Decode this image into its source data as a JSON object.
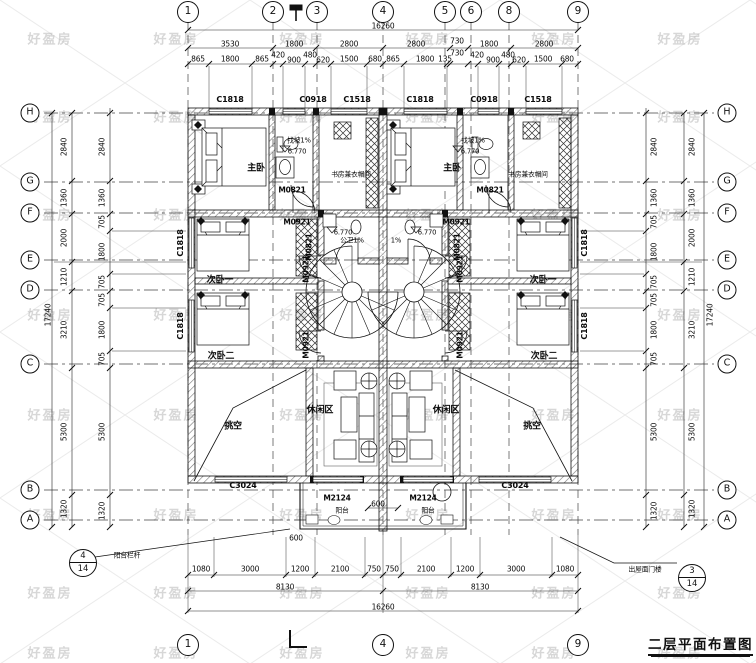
{
  "meta": {
    "title": "二层平面布置图",
    "watermark": "好盈房"
  },
  "callouts": {
    "left": {
      "num": "4",
      "den": "14",
      "text": "阳台栏杆"
    },
    "right": {
      "num": "3",
      "den": "14",
      "text": "出屋面门楼"
    }
  },
  "grid": {
    "bubbles": [
      {
        "t": "1",
        "x": 188,
        "y": 12,
        "s": "t"
      },
      {
        "t": "2",
        "x": 273,
        "y": 12,
        "s": "t"
      },
      {
        "t": "3",
        "x": 317,
        "y": 12,
        "s": "t"
      },
      {
        "t": "4",
        "x": 383,
        "y": 12,
        "s": "t"
      },
      {
        "t": "5",
        "x": 445,
        "y": 12,
        "s": "t"
      },
      {
        "t": "6",
        "x": 471,
        "y": 12,
        "s": "t"
      },
      {
        "t": "8",
        "x": 509,
        "y": 12,
        "s": "t"
      },
      {
        "t": "9",
        "x": 578,
        "y": 12,
        "s": "t"
      },
      {
        "t": "1",
        "x": 188,
        "y": 645,
        "s": "t"
      },
      {
        "t": "4",
        "x": 383,
        "y": 645,
        "s": "t"
      },
      {
        "t": "9",
        "x": 578,
        "y": 645,
        "s": "t"
      },
      {
        "t": "H",
        "x": 30,
        "y": 113,
        "s": "s"
      },
      {
        "t": "G",
        "x": 30,
        "y": 182,
        "s": "s"
      },
      {
        "t": "F",
        "x": 30,
        "y": 213,
        "s": "s"
      },
      {
        "t": "E",
        "x": 30,
        "y": 260,
        "s": "s"
      },
      {
        "t": "D",
        "x": 30,
        "y": 290,
        "s": "s"
      },
      {
        "t": "C",
        "x": 30,
        "y": 364,
        "s": "s"
      },
      {
        "t": "B",
        "x": 30,
        "y": 490,
        "s": "s"
      },
      {
        "t": "A",
        "x": 30,
        "y": 520,
        "s": "s"
      },
      {
        "t": "H",
        "x": 727,
        "y": 113,
        "s": "s"
      },
      {
        "t": "G",
        "x": 727,
        "y": 182,
        "s": "s"
      },
      {
        "t": "F",
        "x": 727,
        "y": 213,
        "s": "s"
      },
      {
        "t": "E",
        "x": 727,
        "y": 260,
        "s": "s"
      },
      {
        "t": "D",
        "x": 727,
        "y": 290,
        "s": "s"
      },
      {
        "t": "C",
        "x": 727,
        "y": 364,
        "s": "s"
      },
      {
        "t": "B",
        "x": 727,
        "y": 490,
        "s": "s"
      },
      {
        "t": "A",
        "x": 727,
        "y": 520,
        "s": "s"
      }
    ]
  },
  "labels": [
    {
      "t": "16260",
      "x": 383,
      "y": 26,
      "c": "dim"
    },
    {
      "t": "3530",
      "x": 230,
      "y": 44,
      "c": "dim"
    },
    {
      "t": "1800",
      "x": 294,
      "y": 44,
      "c": "dim"
    },
    {
      "t": "2800",
      "x": 349,
      "y": 44,
      "c": "dim"
    },
    {
      "t": "2800",
      "x": 416,
      "y": 44,
      "c": "dim"
    },
    {
      "t": "730",
      "x": 457,
      "y": 41,
      "c": "dim"
    },
    {
      "t": "1800",
      "x": 489,
      "y": 44,
      "c": "dim"
    },
    {
      "t": "2800",
      "x": 544,
      "y": 44,
      "c": "dim"
    },
    {
      "t": "865",
      "x": 198,
      "y": 59,
      "c": "dim"
    },
    {
      "t": "1800",
      "x": 230,
      "y": 59,
      "c": "dim"
    },
    {
      "t": "865",
      "x": 262,
      "y": 59,
      "c": "dim"
    },
    {
      "t": "420",
      "x": 278,
      "y": 55,
      "c": "dim"
    },
    {
      "t": "900",
      "x": 294,
      "y": 60,
      "c": "dim"
    },
    {
      "t": "480",
      "x": 310,
      "y": 55,
      "c": "dim"
    },
    {
      "t": "620",
      "x": 323,
      "y": 60,
      "c": "dim"
    },
    {
      "t": "1500",
      "x": 349,
      "y": 59,
      "c": "dim"
    },
    {
      "t": "680",
      "x": 375,
      "y": 59,
      "c": "dim"
    },
    {
      "t": "865",
      "x": 393,
      "y": 59,
      "c": "dim"
    },
    {
      "t": "1800",
      "x": 425,
      "y": 59,
      "c": "dim"
    },
    {
      "t": "135",
      "x": 445,
      "y": 59,
      "c": "dim"
    },
    {
      "t": "730",
      "x": 457,
      "y": 53,
      "c": "dim"
    },
    {
      "t": "420",
      "x": 477,
      "y": 55,
      "c": "dim"
    },
    {
      "t": "900",
      "x": 493,
      "y": 60,
      "c": "dim"
    },
    {
      "t": "480",
      "x": 508,
      "y": 55,
      "c": "dim"
    },
    {
      "t": "620",
      "x": 519,
      "y": 60,
      "c": "dim"
    },
    {
      "t": "1500",
      "x": 543,
      "y": 59,
      "c": "dim"
    },
    {
      "t": "680",
      "x": 567,
      "y": 59,
      "c": "dim"
    },
    {
      "t": "C1818",
      "x": 230,
      "y": 100,
      "c": "win"
    },
    {
      "t": "C0918",
      "x": 313,
      "y": 100,
      "c": "win"
    },
    {
      "t": "C1518",
      "x": 357,
      "y": 100,
      "c": "win"
    },
    {
      "t": "C1818",
      "x": 420,
      "y": 100,
      "c": "win"
    },
    {
      "t": "C0918",
      "x": 484,
      "y": 100,
      "c": "win"
    },
    {
      "t": "C1518",
      "x": 538,
      "y": 100,
      "c": "win"
    },
    {
      "t": "17240",
      "x": 48,
      "y": 315,
      "c": "dimv"
    },
    {
      "t": "2840",
      "x": 64,
      "y": 147,
      "c": "dimv"
    },
    {
      "t": "1360",
      "x": 64,
      "y": 198,
      "c": "dimv"
    },
    {
      "t": "2000",
      "x": 64,
      "y": 238,
      "c": "dimv"
    },
    {
      "t": "1210",
      "x": 64,
      "y": 277,
      "c": "dimv"
    },
    {
      "t": "3210",
      "x": 64,
      "y": 330,
      "c": "dimv"
    },
    {
      "t": "5300",
      "x": 64,
      "y": 432,
      "c": "dimv"
    },
    {
      "t": "1320",
      "x": 64,
      "y": 509,
      "c": "dimv"
    },
    {
      "t": "2840",
      "x": 102,
      "y": 147,
      "c": "dimv"
    },
    {
      "t": "1360",
      "x": 102,
      "y": 198,
      "c": "dimv"
    },
    {
      "t": "705",
      "x": 102,
      "y": 222,
      "c": "dimv"
    },
    {
      "t": "1800",
      "x": 102,
      "y": 252,
      "c": "dimv"
    },
    {
      "t": "705",
      "x": 102,
      "y": 282,
      "c": "dimv"
    },
    {
      "t": "705",
      "x": 102,
      "y": 300,
      "c": "dimv"
    },
    {
      "t": "1800",
      "x": 102,
      "y": 330,
      "c": "dimv"
    },
    {
      "t": "705",
      "x": 102,
      "y": 359,
      "c": "dimv"
    },
    {
      "t": "5300",
      "x": 102,
      "y": 432,
      "c": "dimv"
    },
    {
      "t": "1320",
      "x": 102,
      "y": 511,
      "c": "dimv"
    },
    {
      "t": "C1818",
      "x": 181,
      "y": 243,
      "c": "winv"
    },
    {
      "t": "C1818",
      "x": 181,
      "y": 326,
      "c": "winv"
    },
    {
      "t": "C1818",
      "x": 585,
      "y": 243,
      "c": "winv"
    },
    {
      "t": "C1818",
      "x": 585,
      "y": 326,
      "c": "winv"
    },
    {
      "t": "2840",
      "x": 654,
      "y": 147,
      "c": "dimv"
    },
    {
      "t": "1360",
      "x": 654,
      "y": 198,
      "c": "dimv"
    },
    {
      "t": "705",
      "x": 654,
      "y": 222,
      "c": "dimv"
    },
    {
      "t": "1800",
      "x": 654,
      "y": 252,
      "c": "dimv"
    },
    {
      "t": "705",
      "x": 654,
      "y": 282,
      "c": "dimv"
    },
    {
      "t": "705",
      "x": 654,
      "y": 300,
      "c": "dimv"
    },
    {
      "t": "1800",
      "x": 654,
      "y": 330,
      "c": "dimv"
    },
    {
      "t": "705",
      "x": 654,
      "y": 359,
      "c": "dimv"
    },
    {
      "t": "5300",
      "x": 654,
      "y": 432,
      "c": "dimv"
    },
    {
      "t": "1320",
      "x": 654,
      "y": 511,
      "c": "dimv"
    },
    {
      "t": "2840",
      "x": 692,
      "y": 147,
      "c": "dimv"
    },
    {
      "t": "1360",
      "x": 692,
      "y": 198,
      "c": "dimv"
    },
    {
      "t": "2000",
      "x": 692,
      "y": 238,
      "c": "dimv"
    },
    {
      "t": "1210",
      "x": 692,
      "y": 277,
      "c": "dimv"
    },
    {
      "t": "3210",
      "x": 692,
      "y": 330,
      "c": "dimv"
    },
    {
      "t": "5300",
      "x": 692,
      "y": 432,
      "c": "dimv"
    },
    {
      "t": "1320",
      "x": 692,
      "y": 509,
      "c": "dimv"
    },
    {
      "t": "17240",
      "x": 710,
      "y": 315,
      "c": "dimv"
    },
    {
      "t": "600",
      "x": 378,
      "y": 504,
      "c": "dim"
    },
    {
      "t": "600",
      "x": 296,
      "y": 538,
      "c": "dim"
    },
    {
      "t": "1080",
      "x": 201,
      "y": 569,
      "c": "dim"
    },
    {
      "t": "3000",
      "x": 250,
      "y": 569,
      "c": "dim"
    },
    {
      "t": "1200",
      "x": 300,
      "y": 569,
      "c": "dim"
    },
    {
      "t": "2100",
      "x": 340,
      "y": 569,
      "c": "dim"
    },
    {
      "t": "750",
      "x": 374,
      "y": 569,
      "c": "dim"
    },
    {
      "t": "750",
      "x": 392,
      "y": 569,
      "c": "dim"
    },
    {
      "t": "2100",
      "x": 426,
      "y": 569,
      "c": "dim"
    },
    {
      "t": "1200",
      "x": 465,
      "y": 569,
      "c": "dim"
    },
    {
      "t": "3000",
      "x": 516,
      "y": 569,
      "c": "dim"
    },
    {
      "t": "1080",
      "x": 565,
      "y": 569,
      "c": "dim"
    },
    {
      "t": "8130",
      "x": 285,
      "y": 587,
      "c": "dim"
    },
    {
      "t": "8130",
      "x": 480,
      "y": 587,
      "c": "dim"
    },
    {
      "t": "16260",
      "x": 383,
      "y": 607,
      "c": "dim"
    },
    {
      "t": "C3024",
      "x": 243,
      "y": 486,
      "c": "win"
    },
    {
      "t": "C3024",
      "x": 515,
      "y": 486,
      "c": "win"
    },
    {
      "t": "M2124",
      "x": 337,
      "y": 498,
      "c": "door"
    },
    {
      "t": "M2124",
      "x": 423,
      "y": 498,
      "c": "door"
    },
    {
      "t": "阳台",
      "x": 342,
      "y": 511,
      "c": "tiny"
    },
    {
      "t": "阳台",
      "x": 428,
      "y": 511,
      "c": "tiny"
    },
    {
      "t": "主卧",
      "x": 256,
      "y": 169,
      "c": "room"
    },
    {
      "t": "主卧",
      "x": 452,
      "y": 169,
      "c": "room"
    },
    {
      "t": "书房兼衣帽间",
      "x": 351,
      "y": 175,
      "c": "tiny"
    },
    {
      "t": "书房兼衣帽间",
      "x": 528,
      "y": 175,
      "c": "tiny"
    },
    {
      "t": "次卧一",
      "x": 220,
      "y": 281,
      "c": "room"
    },
    {
      "t": "次卧一",
      "x": 543,
      "y": 281,
      "c": "room"
    },
    {
      "t": "次卧二",
      "x": 221,
      "y": 357,
      "c": "room"
    },
    {
      "t": "次卧二",
      "x": 544,
      "y": 357,
      "c": "room"
    },
    {
      "t": "休闲区",
      "x": 320,
      "y": 411,
      "c": "room"
    },
    {
      "t": "休闲区",
      "x": 446,
      "y": 411,
      "c": "room"
    },
    {
      "t": "挑空",
      "x": 233,
      "y": 427,
      "c": "room"
    },
    {
      "t": "挑空",
      "x": 532,
      "y": 427,
      "c": "room"
    },
    {
      "t": "公卫1%",
      "x": 352,
      "y": 241,
      "c": "tiny"
    },
    {
      "t": "1%",
      "x": 396,
      "y": 241,
      "c": "tiny"
    },
    {
      "t": "找坡1%",
      "x": 299,
      "y": 141,
      "c": "tiny"
    },
    {
      "t": "找坡1%",
      "x": 473,
      "y": 141,
      "c": "tiny"
    },
    {
      "t": "6.770",
      "x": 297,
      "y": 152,
      "c": "tiny"
    },
    {
      "t": "6.770",
      "x": 470,
      "y": 152,
      "c": "tiny"
    },
    {
      "t": "6.770",
      "x": 343,
      "y": 233,
      "c": "tiny"
    },
    {
      "t": "6.770",
      "x": 427,
      "y": 233,
      "c": "tiny"
    },
    {
      "t": "M0821",
      "x": 292,
      "y": 190,
      "c": "door"
    },
    {
      "t": "M0821",
      "x": 490,
      "y": 190,
      "c": "door"
    },
    {
      "t": "M0821",
      "x": 309,
      "y": 247,
      "c": "doorv"
    },
    {
      "t": "M0821",
      "x": 457,
      "y": 247,
      "c": "doorv"
    },
    {
      "t": "M0921",
      "x": 297,
      "y": 222,
      "c": "door"
    },
    {
      "t": "M0921",
      "x": 456,
      "y": 222,
      "c": "door"
    },
    {
      "t": "M0921",
      "x": 306,
      "y": 269,
      "c": "doorv"
    },
    {
      "t": "M0921",
      "x": 306,
      "y": 345,
      "c": "doorv"
    },
    {
      "t": "M0921",
      "x": 460,
      "y": 269,
      "c": "doorv"
    },
    {
      "t": "M0921",
      "x": 460,
      "y": 345,
      "c": "doorv"
    }
  ]
}
